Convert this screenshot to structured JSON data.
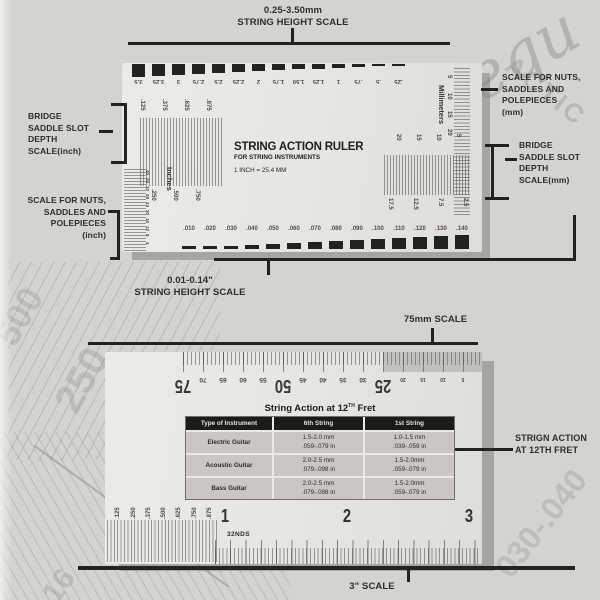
{
  "photo": {
    "bg": "#d5d3d0",
    "card_color": "#e9e7e3",
    "ink": "#232220"
  },
  "callouts": {
    "top": {
      "line1": "0.25-3.50mm",
      "line2": "STRING HEIGHT SCALE"
    },
    "left_top": {
      "lines": [
        "BRIDGE",
        "SADDLE SLOT",
        "DEPTH",
        "SCALE(inch)"
      ]
    },
    "left_bottom": {
      "lines": [
        "SCALE FOR NUTS,",
        "SADDLES AND",
        "POLEPIECES",
        "(inch)"
      ]
    },
    "right_top": {
      "lines": [
        "SCALE FOR NUTS,",
        "SADDLES AND",
        "POLEPIECES",
        "(mm)"
      ]
    },
    "right_bottom": {
      "lines": [
        "BRIDGE",
        "SADDLE SLOT",
        "DEPTH",
        "SCALE(mm)"
      ]
    },
    "bottom": {
      "line1": "0.01-0.14\"",
      "line2": "STRING HEIGHT SCALE"
    },
    "ruler2_top": "75mm SCALE",
    "ruler2_right": {
      "line1": "STRIGN ACTION",
      "line2": "AT 12TH FRET"
    },
    "ruler2_bottom": "3\" SCALE"
  },
  "ruler1": {
    "title": "STRING ACTION RULER",
    "subtitle": "FOR STRING INSTRUMENTS",
    "conversion": "1 INCH = 25.4 MM",
    "mm_gauge_labels": [
      "3.5",
      "3.25",
      "3",
      "2.75",
      "2.5",
      "2.25",
      "2",
      "1.75",
      "1.50",
      "1.25",
      "1",
      ".75",
      ".5",
      ".25"
    ],
    "inch_gauge_labels": [
      ".010",
      ".020",
      ".030",
      ".040",
      ".050",
      ".060",
      ".070",
      ".080",
      ".090",
      ".100",
      ".110",
      ".120",
      ".130",
      ".140"
    ],
    "saddle_inch_top": [
      ".125",
      ".375",
      ".625",
      ".875"
    ],
    "saddle_inch_bottom": [
      ".250",
      ".500",
      ".750"
    ],
    "nut_mm_top": [
      "20",
      "15",
      "10",
      "5"
    ],
    "nut_mm_bottom": [
      "17.5",
      "12.5",
      "7.5",
      "2.5"
    ],
    "inches_label": "Inches",
    "millimeters_label": "Millimeters",
    "mm_edge_numbers": [
      "5",
      "10",
      "15",
      "20"
    ],
    "inch_edge_numbers": [
      "40",
      "36",
      "32",
      "28",
      "24",
      "20",
      "16",
      "12",
      "8",
      "4"
    ]
  },
  "ruler2": {
    "mm_major": [
      "75",
      "50",
      "25"
    ],
    "mm_minor": [
      "70",
      "65",
      "60",
      "55",
      "45",
      "40",
      "35",
      "30"
    ],
    "mm_minor_small": [
      "20",
      "15",
      "10",
      "5"
    ],
    "inch_fractions": [
      ".125",
      ".250",
      ".375",
      ".500",
      ".625",
      ".750",
      ".875"
    ],
    "inch_major": [
      "1",
      "2",
      "3"
    ],
    "units_label": "32NDS",
    "table": {
      "title_prefix": "String Action at 12",
      "title_sup": "TH",
      "title_suffix": " Fret",
      "headers": [
        "Type of Instrument",
        "6th String",
        "1st String"
      ],
      "rows": [
        [
          "Electric Guitar",
          "1.5-2.0 mm\n.059-.079 in",
          "1.0-1.5 mm\n.039-.059 in"
        ],
        [
          "Acoustic Guitar",
          "2.0-2.5 mm\n.079-.098 in",
          "1.5-2.0mm\n.059-.079 in"
        ],
        [
          "Bass Guitar",
          "2.0-2.5 mm\n.079-.098 in",
          "1.5-2.0mm\n.059-.079 in"
        ]
      ]
    }
  },
  "watermarks": {
    "texts": [
      "requ",
      "ACTIC",
      "500",
      "250",
      "030-.040",
      "16"
    ]
  }
}
